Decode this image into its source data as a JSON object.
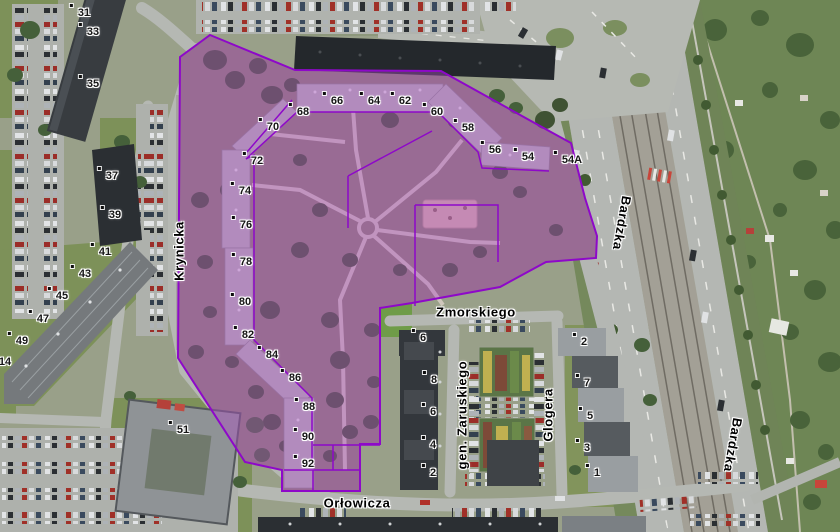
{
  "colors": {
    "parcel_fill": "rgba(173,78,196,0.42)",
    "parcel_stroke": "#8e08c9"
  },
  "labels": {
    "building_numbers": [
      {
        "text": "31",
        "x": 84,
        "y": 13
      },
      {
        "text": "33",
        "x": 93,
        "y": 32
      },
      {
        "text": "35",
        "x": 93,
        "y": 84
      },
      {
        "text": "37",
        "x": 112,
        "y": 176
      },
      {
        "text": "39",
        "x": 115,
        "y": 215
      },
      {
        "text": "41",
        "x": 105,
        "y": 252
      },
      {
        "text": "43",
        "x": 85,
        "y": 274
      },
      {
        "text": "45",
        "x": 62,
        "y": 296
      },
      {
        "text": "47",
        "x": 43,
        "y": 319
      },
      {
        "text": "49",
        "x": 22,
        "y": 341
      },
      {
        "text": "14",
        "x": 5,
        "y": 362
      },
      {
        "text": "51",
        "x": 183,
        "y": 430
      },
      {
        "text": "68",
        "x": 303,
        "y": 112
      },
      {
        "text": "66",
        "x": 337,
        "y": 101
      },
      {
        "text": "64",
        "x": 374,
        "y": 101
      },
      {
        "text": "62",
        "x": 405,
        "y": 101
      },
      {
        "text": "60",
        "x": 437,
        "y": 112
      },
      {
        "text": "58",
        "x": 468,
        "y": 128
      },
      {
        "text": "56",
        "x": 495,
        "y": 150
      },
      {
        "text": "54",
        "x": 528,
        "y": 157
      },
      {
        "text": "54A",
        "x": 572,
        "y": 160
      },
      {
        "text": "70",
        "x": 273,
        "y": 127
      },
      {
        "text": "72",
        "x": 257,
        "y": 161
      },
      {
        "text": "74",
        "x": 245,
        "y": 191
      },
      {
        "text": "76",
        "x": 246,
        "y": 225
      },
      {
        "text": "78",
        "x": 246,
        "y": 262
      },
      {
        "text": "80",
        "x": 245,
        "y": 302
      },
      {
        "text": "82",
        "x": 248,
        "y": 335
      },
      {
        "text": "84",
        "x": 272,
        "y": 355
      },
      {
        "text": "86",
        "x": 295,
        "y": 378
      },
      {
        "text": "88",
        "x": 309,
        "y": 407
      },
      {
        "text": "90",
        "x": 308,
        "y": 437
      },
      {
        "text": "92",
        "x": 308,
        "y": 464
      },
      {
        "text": "6",
        "x": 423,
        "y": 338
      },
      {
        "text": "8",
        "x": 434,
        "y": 380
      },
      {
        "text": "6",
        "x": 433,
        "y": 412
      },
      {
        "text": "4",
        "x": 433,
        "y": 445
      },
      {
        "text": "2",
        "x": 433,
        "y": 473
      },
      {
        "text": "2",
        "x": 584,
        "y": 342
      },
      {
        "text": "7",
        "x": 587,
        "y": 383
      },
      {
        "text": "5",
        "x": 590,
        "y": 416
      },
      {
        "text": "3",
        "x": 587,
        "y": 448
      },
      {
        "text": "1",
        "x": 597,
        "y": 473
      }
    ],
    "street_names": [
      {
        "text": "Krynicka",
        "x": 179,
        "y": 251,
        "rot": -90
      },
      {
        "text": "Bardzka",
        "x": 622,
        "y": 223,
        "rot": 100
      },
      {
        "text": "Bardzka",
        "x": 733,
        "y": 445,
        "rot": 100
      },
      {
        "text": "Zmorskiego",
        "x": 476,
        "y": 312,
        "rot": 0
      },
      {
        "text": "gen. Zaruskiego",
        "x": 462,
        "y": 415,
        "rot": -90
      },
      {
        "text": "Glogera",
        "x": 548,
        "y": 415,
        "rot": -90
      },
      {
        "text": "Orłowicza",
        "x": 357,
        "y": 503,
        "rot": 0
      }
    ]
  }
}
